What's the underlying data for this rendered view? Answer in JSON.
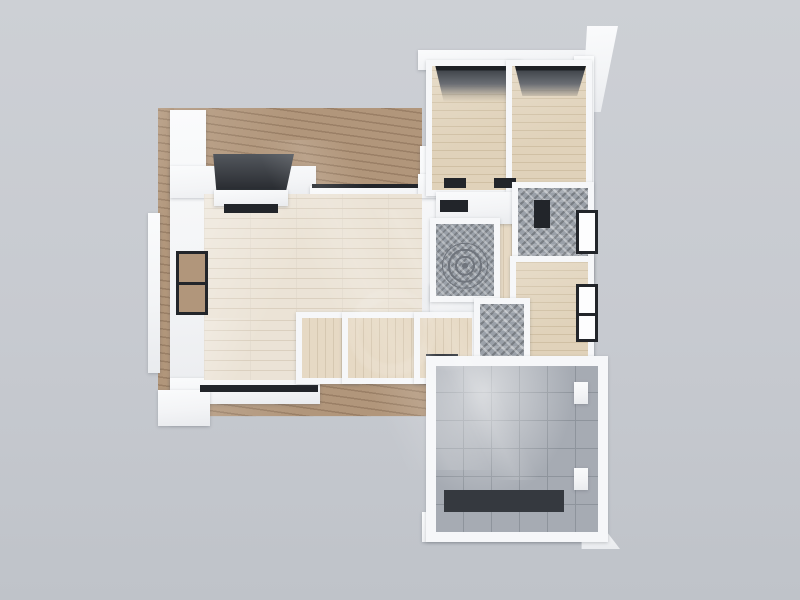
{
  "scene": {
    "description": "3D rendered apartment floor plan, top-down dollhouse view on plain gray backdrop",
    "view": "top-down 3d render",
    "visible_text": "none (only a faint illegible diagonal watermark sheen)"
  },
  "colors": {
    "background-top": "#cdd0d5",
    "background-mid": "#c7cad0",
    "background-bottom": "#bfc3c9",
    "wall": "#f6f7f9",
    "deck": "#b1967b",
    "living-floor": "#ebe3d6",
    "living-line": "#dbd0bf",
    "tan-floor": "#e0d2ba",
    "tan-line": "#d0c0a4",
    "corridor-floor": "#e6d9c4",
    "tile-floor": "#a6abb3",
    "tile-line": "#8e949c",
    "mosaic": "#9aa0a8",
    "mosaic-dark": "#70757d",
    "window-dark": "#22252a",
    "mat-dark": "#35393f",
    "unit-top": "#53575d",
    "unit-dark": "#2b2e33"
  },
  "rooms": [
    {
      "id": "terrace-deck",
      "floor": "brown wood decking, L-shaped around top-left"
    },
    {
      "id": "living-room",
      "floor": "pale plank wood, large L-shaped space"
    },
    {
      "id": "bedroom-1",
      "floor": "tan plank wood, dark window lintel at top"
    },
    {
      "id": "bedroom-2",
      "floor": "tan plank wood, dark window lintel at top"
    },
    {
      "id": "corridor",
      "floor": "tan plank wood"
    },
    {
      "id": "bathroom-1",
      "floor": "gray mosaic tile with circular motif"
    },
    {
      "id": "bathroom-2",
      "floor": "gray patterned mosaic tile"
    },
    {
      "id": "small-room",
      "floor": "tan plank wood, side window on right wall"
    },
    {
      "id": "closet-1",
      "floor": "tan plank wood cubby"
    },
    {
      "id": "closet-2",
      "floor": "tan plank wood cubby"
    },
    {
      "id": "entry-closet",
      "floor": "tan plank wood with dark doormat"
    },
    {
      "id": "utility-bath",
      "floor": "gray mosaic tile strip"
    },
    {
      "id": "tiled-room",
      "floor": "large gray ceramic tile room with dark floor mat"
    }
  ],
  "fixtures": [
    {
      "id": "media-unit",
      "desc": "dark cabinet protruding from living room top wall"
    },
    {
      "id": "shelf-niche",
      "desc": "dark-framed recessed shelves in living room left wall"
    },
    {
      "id": "panorama-window",
      "desc": "black glazing strip along living room bottom wall"
    },
    {
      "id": "hall-doorways",
      "desc": "two dark door openings in hallway wall below bedrooms"
    },
    {
      "id": "bath-vanities",
      "desc": "dark vanity blocks in both bathrooms"
    },
    {
      "id": "side-windows",
      "desc": "dark framed windows on right exterior wall"
    },
    {
      "id": "doormat",
      "desc": "dark entry mat in entry closet"
    },
    {
      "id": "tiled-room-mat",
      "desc": "large dark mat at bottom of tiled room"
    }
  ]
}
